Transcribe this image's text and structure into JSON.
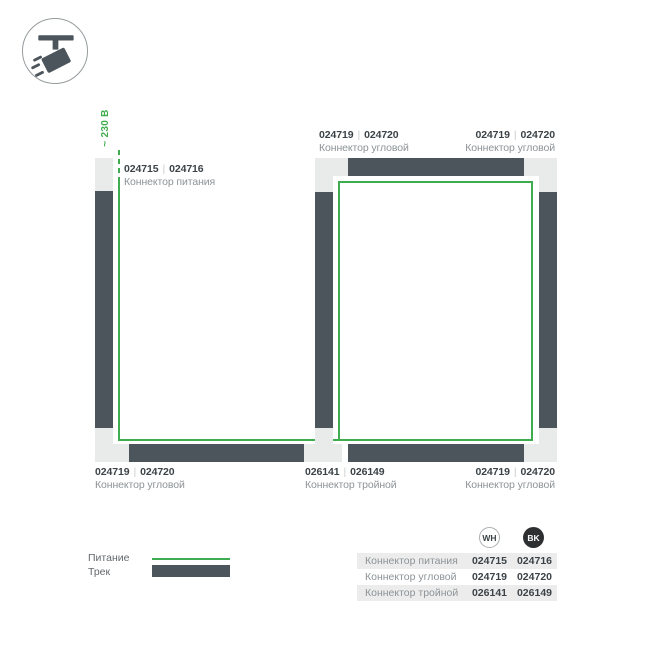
{
  "colors": {
    "green": "#3fad4f",
    "track": "#4c555b",
    "conn": "#e9eaea",
    "ink": "#3c4348",
    "muted": "#8d9397",
    "sep": "#c9cdcf",
    "stripe": "#ececec",
    "legend_text": "#62696d",
    "bk_fill": "#2d2f30",
    "wh_border": "#abb0b3"
  },
  "icon": {
    "name": "track-spotlight"
  },
  "diagram": {
    "voltage": "~ 230 В",
    "sep": "|",
    "labels": [
      {
        "wh": "024715",
        "bk": "024716",
        "name": "Коннектор питания"
      },
      {
        "wh": "024719",
        "bk": "024720",
        "name": "Коннектор угловой"
      },
      {
        "wh": "024719",
        "bk": "024720",
        "name": "Коннектор угловой"
      },
      {
        "wh": "024719",
        "bk": "024720",
        "name": "Коннектор угловой"
      },
      {
        "wh": "026141",
        "bk": "026149",
        "name": "Коннектор тройной"
      },
      {
        "wh": "024719",
        "bk": "024720",
        "name": "Коннектор угловой"
      }
    ]
  },
  "legend": {
    "power_label": "Питание",
    "track_label": "Трек"
  },
  "table": {
    "columns": {
      "wh": "WH",
      "bk": "BK"
    },
    "rows": [
      {
        "name": "Коннектор питания",
        "wh": "024715",
        "bk": "024716"
      },
      {
        "name": "Коннектор угловой",
        "wh": "024719",
        "bk": "024720"
      },
      {
        "name": "Коннектор тройной",
        "wh": "026141",
        "bk": "026149"
      }
    ]
  }
}
